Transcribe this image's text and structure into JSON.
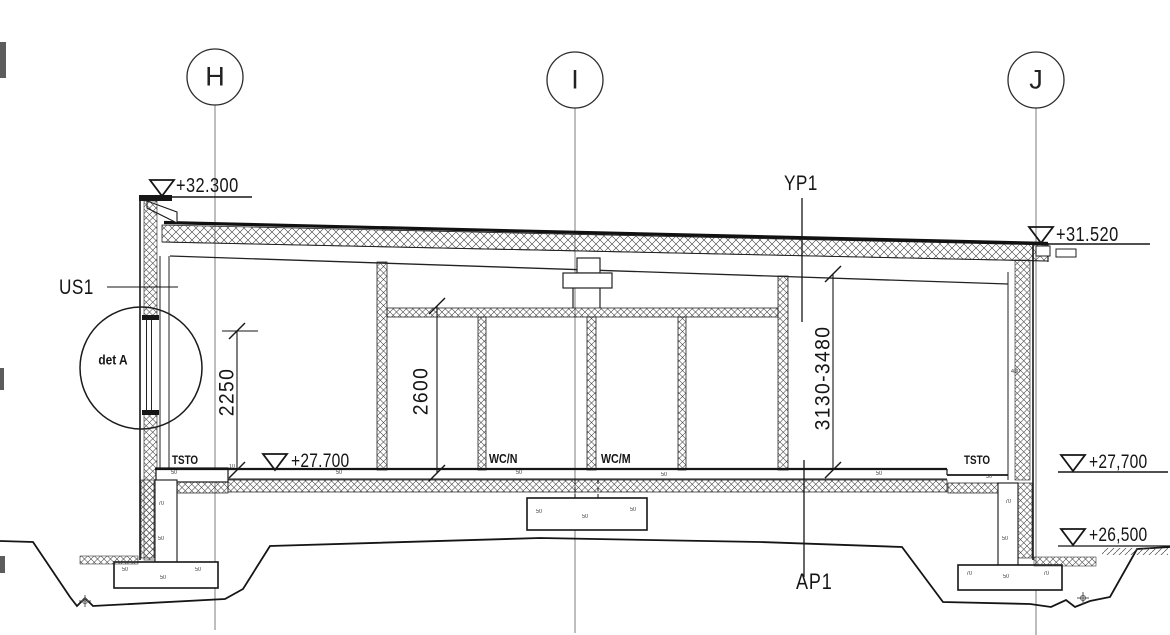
{
  "colors": {
    "line": "#1a1a1a",
    "background": "#ffffff"
  },
  "grid": {
    "h": "H",
    "i": "I",
    "j": "J"
  },
  "elevations": {
    "parapet_left": "+32.300",
    "roof_right": "+31.520",
    "floor_left": "+27.700",
    "floor_right": "+27,700",
    "ground_right": "+26,500"
  },
  "dimensions": {
    "window_height": "2250",
    "wc_ceiling_height": "2600",
    "hall_height_range": "3130-3480"
  },
  "labels": {
    "exterior_wall": "US1",
    "roof_slab": "YP1",
    "ground_slab": "AP1",
    "detail_ref": "det A",
    "room_left": "TSTO",
    "room_right": "TSTO",
    "wc_left": "WC/N",
    "wc_right": "WC/M",
    "wall_thickness": "480"
  },
  "marks": {
    "m1": "50",
    "m2": "50",
    "m3": "50",
    "m4": "70",
    "m5": "50",
    "m6": "50",
    "m7": "10",
    "m8": "50",
    "m9": "50",
    "m10": "50",
    "m11": "50",
    "m12": "50",
    "m13": "50",
    "m14": "50",
    "m15": "50",
    "m16": "70",
    "m17": "50",
    "m18": "70",
    "m19": "70",
    "m20": "50"
  }
}
